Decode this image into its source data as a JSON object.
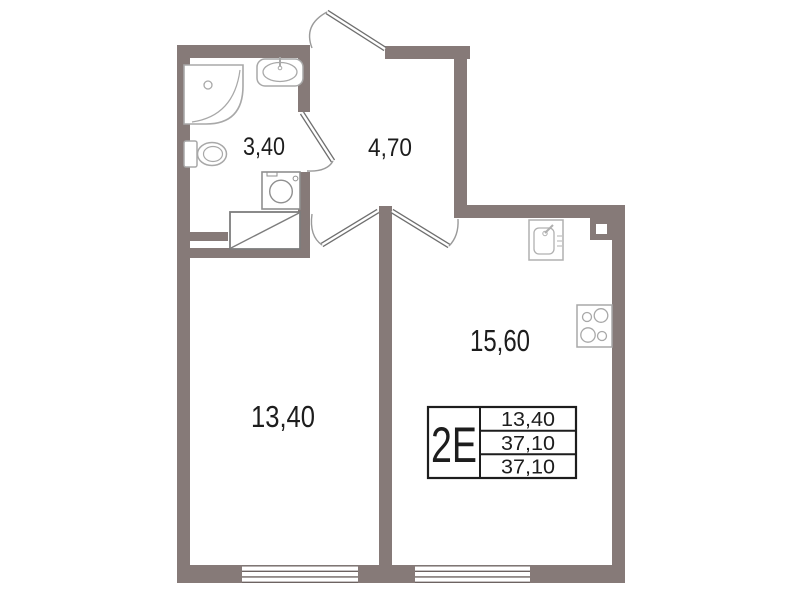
{
  "rooms": [
    {
      "name": "bathroom",
      "area": "3,40"
    },
    {
      "name": "hallway",
      "area": "4,70"
    },
    {
      "name": "living-room",
      "area": "13,40"
    },
    {
      "name": "kitchen-living-room",
      "area": "15,60"
    }
  ],
  "info_table": {
    "type": "2Е",
    "rows": [
      "13,40",
      "37,10",
      "37,10"
    ]
  },
  "fixtures": [
    "corner-bathtub",
    "washbasin",
    "toilet",
    "washing-machine",
    "ventilation-shaft",
    "kitchen-sink",
    "stove",
    "column"
  ],
  "colors": {
    "wall": "#867A78",
    "fixture_line": "#a8a8a8",
    "table_line": "#1d1d1d"
  }
}
